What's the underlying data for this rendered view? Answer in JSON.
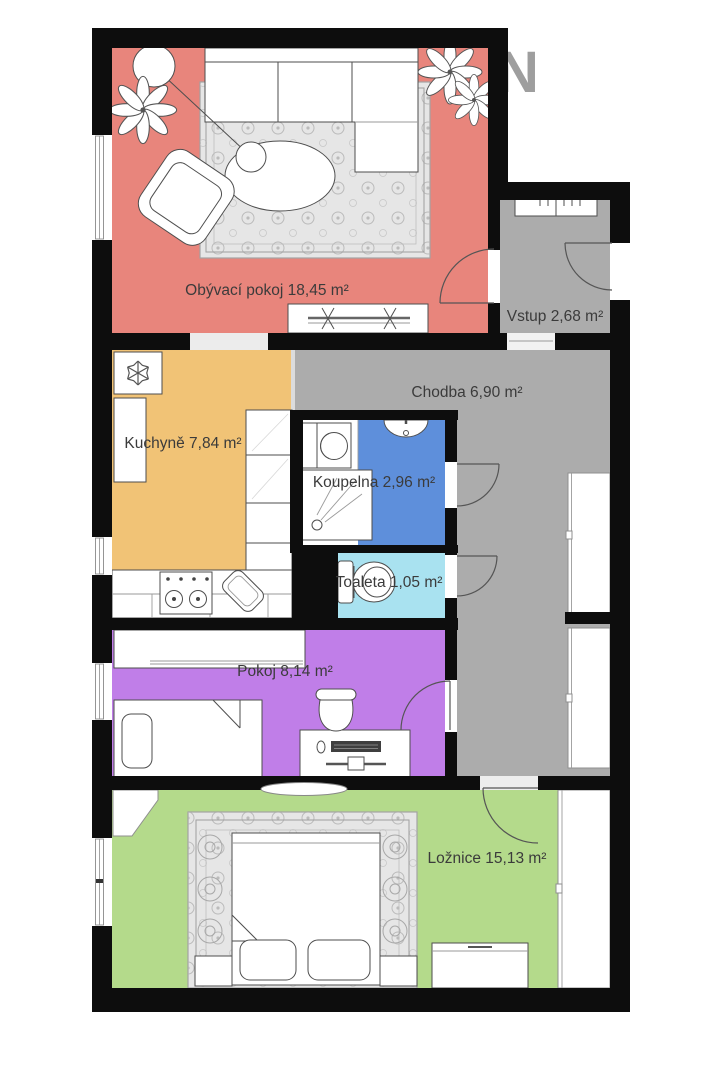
{
  "floorplan": {
    "compass": {
      "label": "N"
    },
    "wall_color": "#0d0d0d",
    "rug_color": "#e6e6e6",
    "rooms": [
      {
        "id": "obyvaci-pokoj",
        "name": "Obývací pokoj",
        "area_m2": "18,45",
        "label": "Obývací pokoj 18,45 m²",
        "floor_color": "#e8857c"
      },
      {
        "id": "vstup",
        "name": "Vstup",
        "area_m2": "2,68",
        "label": "Vstup 2,68 m²",
        "floor_color": "#acacac"
      },
      {
        "id": "chodba",
        "name": "Chodba",
        "area_m2": "6,90",
        "label": "Chodba 6,90 m²",
        "floor_color": "#acacac"
      },
      {
        "id": "kuchyne",
        "name": "Kuchyně",
        "area_m2": "7,84",
        "label": "Kuchyně 7,84 m²",
        "floor_color": "#f1c376"
      },
      {
        "id": "koupelna",
        "name": "Koupelna",
        "area_m2": "2,96",
        "label": "Koupelna 2,96 m²",
        "floor_color": "#5e8fdb"
      },
      {
        "id": "toaleta",
        "name": "Toaleta",
        "area_m2": "1,05",
        "label": "Toaleta 1,05 m²",
        "floor_color": "#a9e2f0"
      },
      {
        "id": "pokoj",
        "name": "Pokoj",
        "area_m2": "8,14",
        "label": "Pokoj 8,14 m²",
        "floor_color": "#c07ee8"
      },
      {
        "id": "loznice",
        "name": "Ložnice",
        "area_m2": "15,13",
        "label": "Ložnice 15,13 m²",
        "floor_color": "#b4da8b"
      }
    ]
  }
}
